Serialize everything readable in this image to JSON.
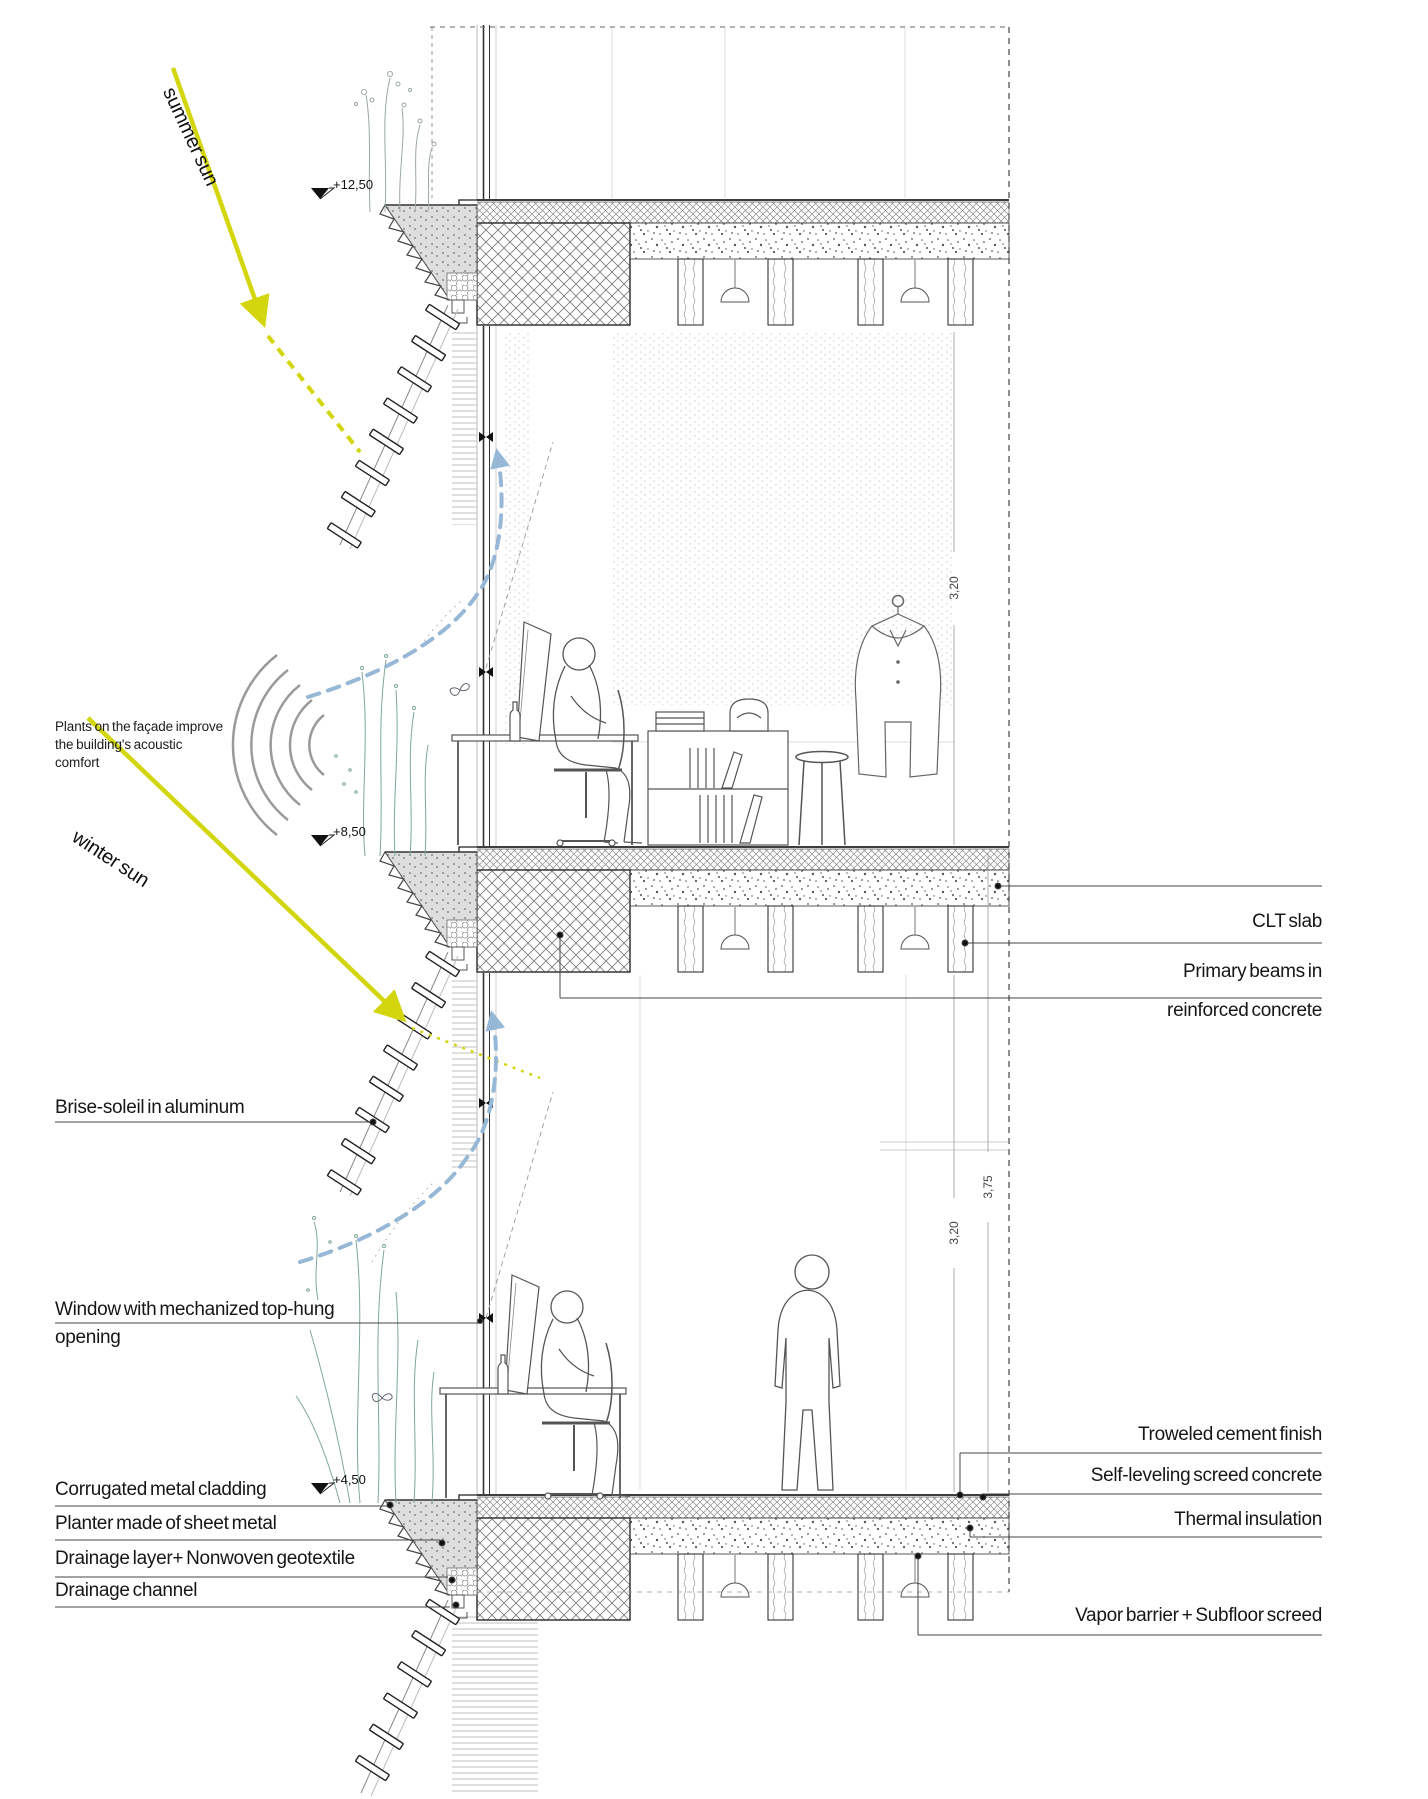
{
  "title": "Facade section detail diagram",
  "labels": {
    "summer_sun": "summer sun",
    "winter_sun": "winter sun",
    "clt_slab": "CLT slab",
    "primary_beams": {
      "line1": "Primary beams in",
      "line2": "reinforced concrete"
    },
    "brise_soleil": "Brise-soleil in aluminum",
    "window": {
      "line1": "Window with mechanized top-hung",
      "line2": "opening"
    },
    "troweled": "Troweled cement finish",
    "self_leveling": "Self-leveling screed concrete",
    "thermal": "Thermal insulation",
    "vapor": "Vapor barrier + Subfloor screed",
    "corrugated": "Corrugated metal cladding",
    "planter": "Planter made of sheet metal",
    "drainage_layer": "Drainage layer+ Nonwoven geotextile",
    "drainage_channel": "Drainage channel"
  },
  "note": {
    "lines": [
      "Plants on the façade improve",
      "the building's acoustic",
      "comfort"
    ]
  },
  "levels": {
    "upper": "+12,50",
    "middle": "+8,50",
    "lower": "+4,50"
  },
  "dimensions": {
    "upper_floor": "3,20",
    "lower_floor_total": "3,75",
    "lower_floor": "3,20"
  },
  "colors": {
    "sun": "#d3d60d",
    "airflow": "#97b7d6",
    "plants": "#7fa897",
    "ink": "#1a1a1a"
  }
}
